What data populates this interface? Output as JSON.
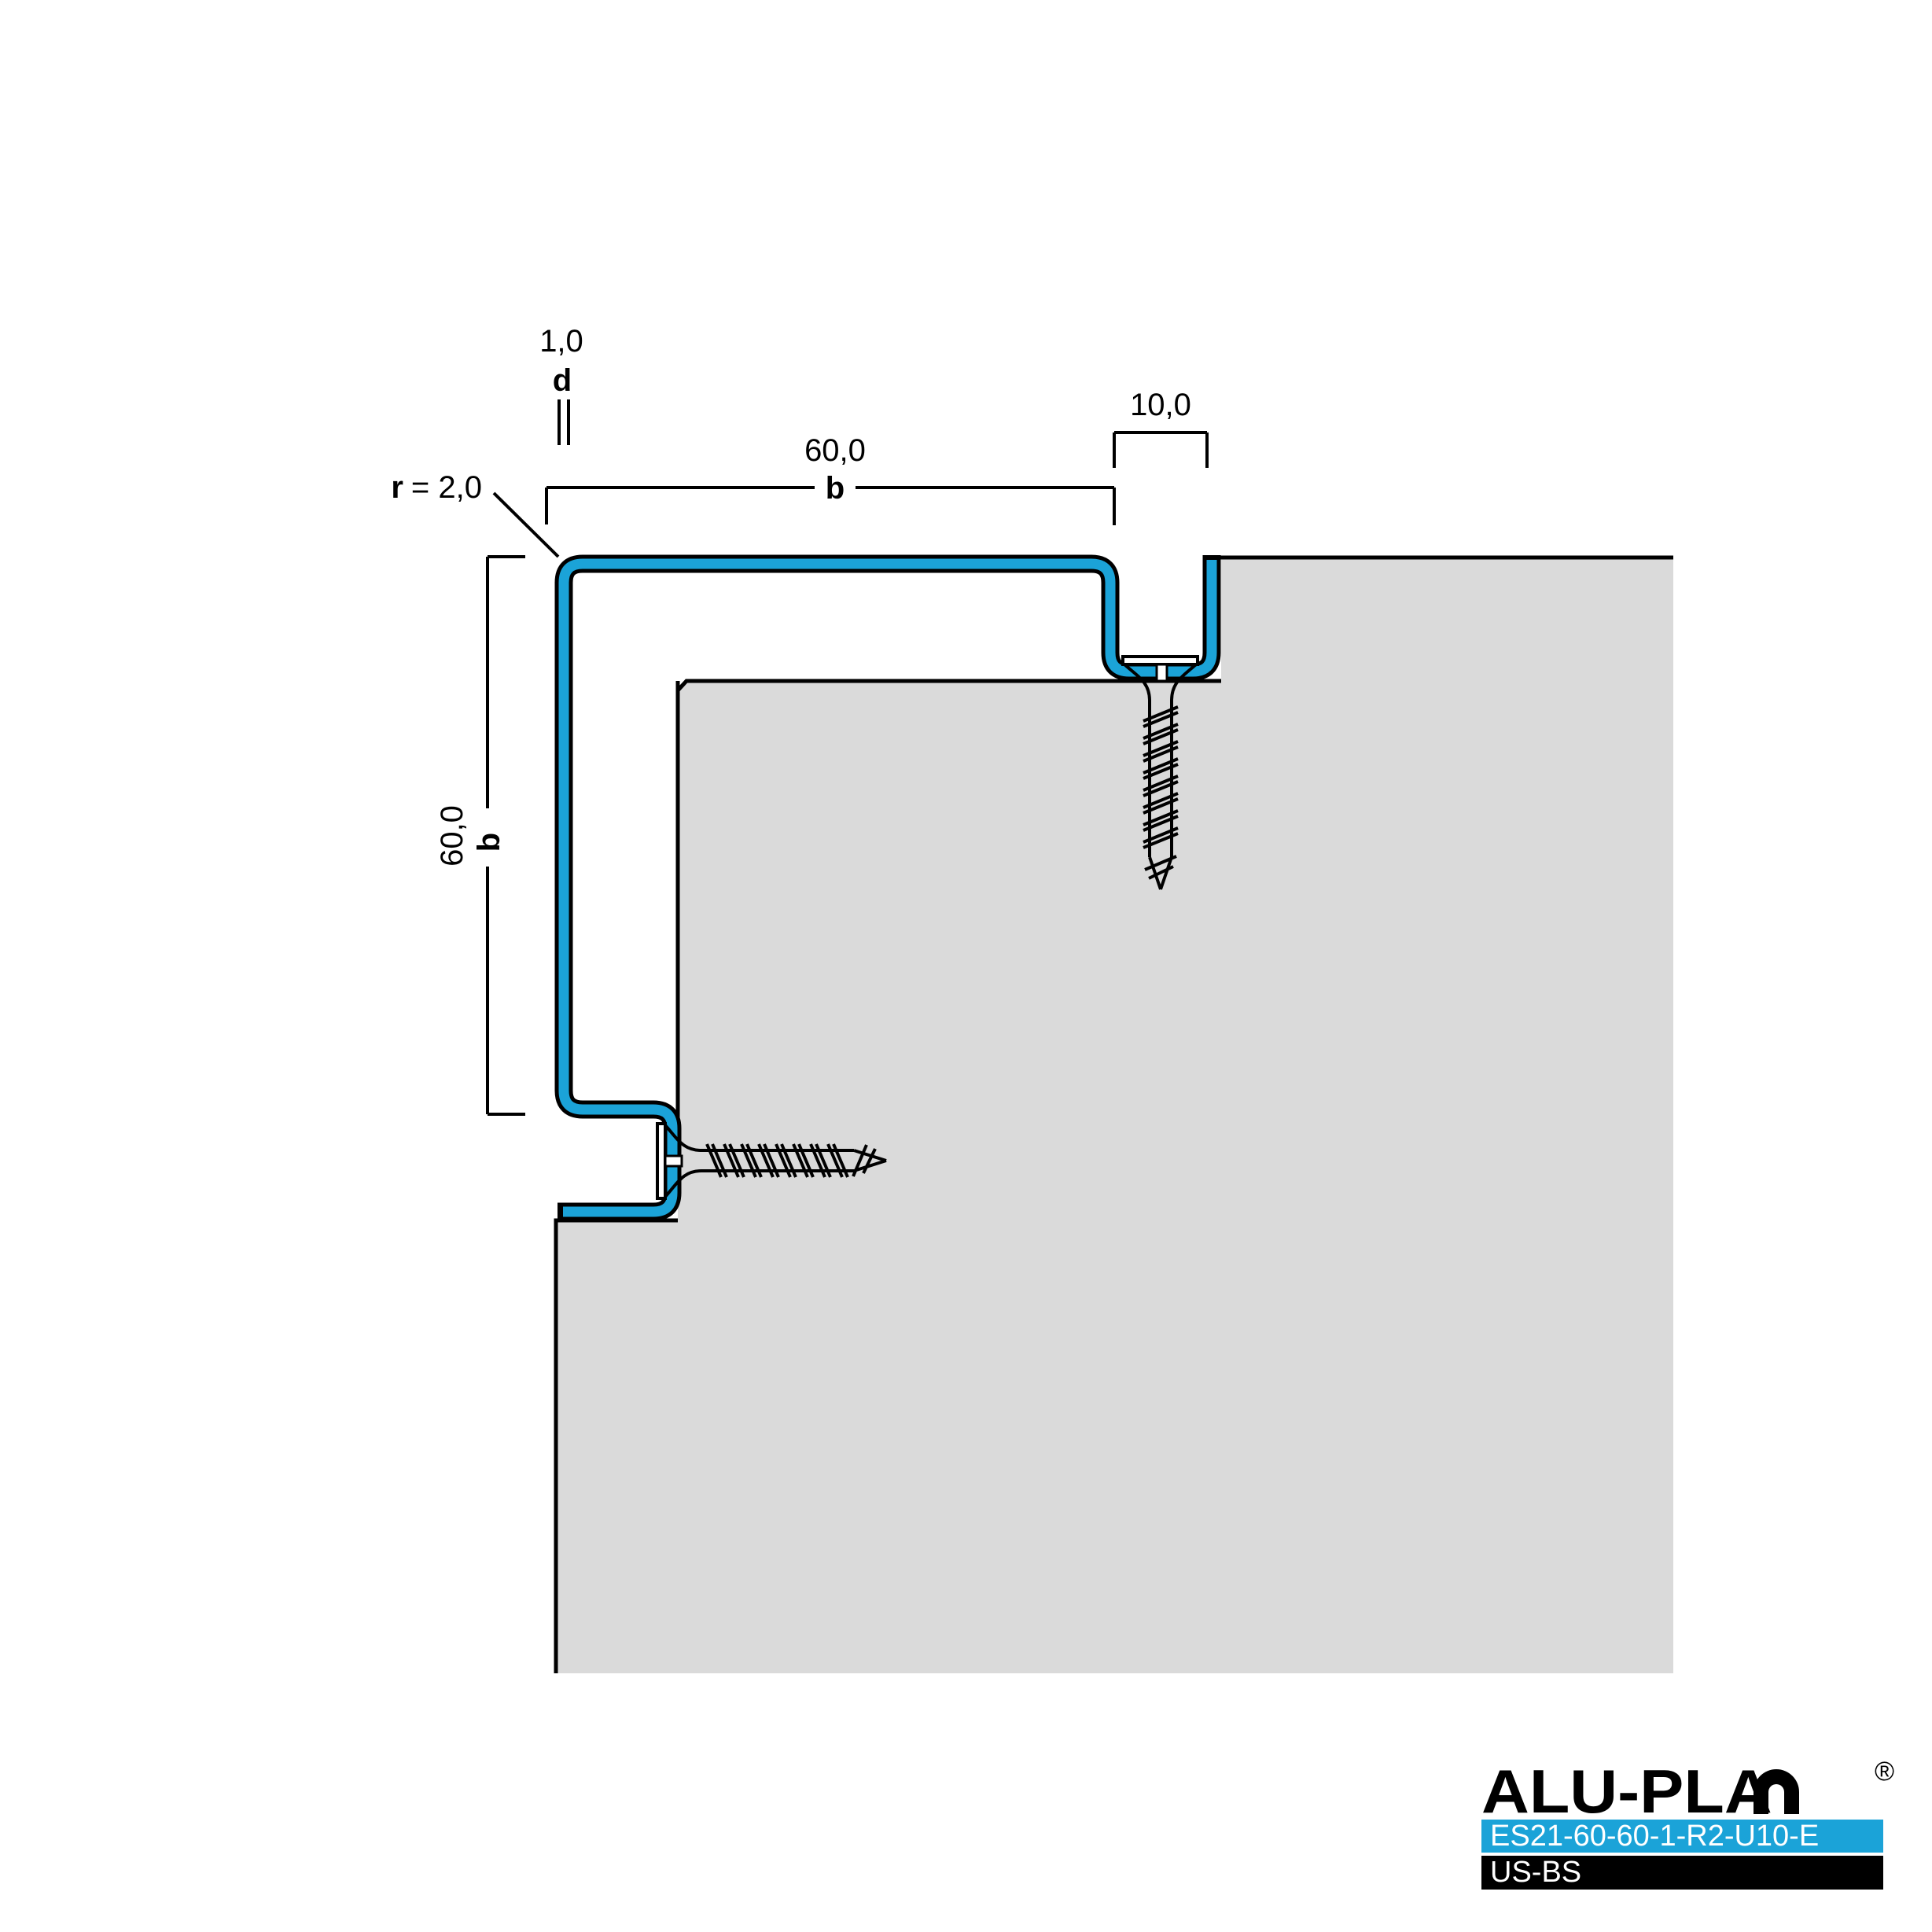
{
  "dimensions": {
    "thickness": {
      "value": "1,0",
      "label": "d"
    },
    "width": {
      "value": "60,0",
      "label": "b"
    },
    "height": {
      "value": "60,0",
      "label": "b"
    },
    "groove_depth": {
      "value": "10,0"
    },
    "radius": {
      "label": "r",
      "value": "= 2,0"
    }
  },
  "colors": {
    "profile_blue": "#1BA3D8",
    "wall_gray": "#DADADA",
    "outline_black": "#000000",
    "screw_fill_white": "#FFFFFF"
  },
  "logo": {
    "brand": "ALU-PLAN",
    "brand_display": "ALU-PLA",
    "registered_mark": "®",
    "product_code": "ES21-60-60-1-R2-U10-E",
    "variant_code": "US-BS"
  }
}
